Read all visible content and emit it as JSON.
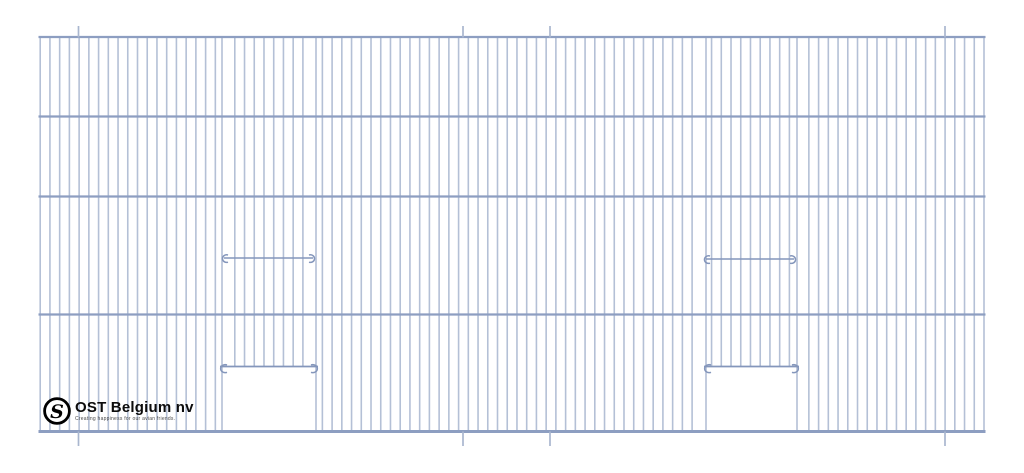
{
  "canvas": {
    "width": 1024,
    "height": 473,
    "background": "#ffffff"
  },
  "logo": {
    "monogram": "S",
    "brand": "OST Belgium nv",
    "tagline": "Creating happiness for our avian friends.",
    "ring_color": "#000000",
    "text_color": "#0c0c0c",
    "tagline_color": "#4a4a4a"
  },
  "drawing": {
    "description": "Wire mesh cage front panel, front view",
    "colors": {
      "bar": "#b4c0d6",
      "rail": "#8d9ec1",
      "wire": "#8496bb",
      "tick": "#a9b6cf"
    },
    "panel": {
      "left": 38.5,
      "right": 985.5,
      "top": 37,
      "bottom": 431.5
    },
    "rails_y": [
      37,
      116.5,
      196.5,
      314.5,
      431.5
    ],
    "bars": {
      "count": 98,
      "first_x": 40.2,
      "last_x": 984,
      "width": 1.6
    },
    "perch_wires": [
      {
        "x1": 219,
        "x2": 318,
        "y": 258
      },
      {
        "x1": 701,
        "x2": 799,
        "y": 259
      }
    ],
    "doors": [
      {
        "x1": 222,
        "x2": 316,
        "rail_y": 366.5
      },
      {
        "x1": 706,
        "x2": 797,
        "rail_y": 366.5
      }
    ],
    "ticks": {
      "xs": [
        78.5,
        463,
        550,
        945
      ],
      "top_y1": 26,
      "top_y2": 37.5,
      "bottom_y1": 431.5,
      "bottom_y2": 446
    }
  }
}
